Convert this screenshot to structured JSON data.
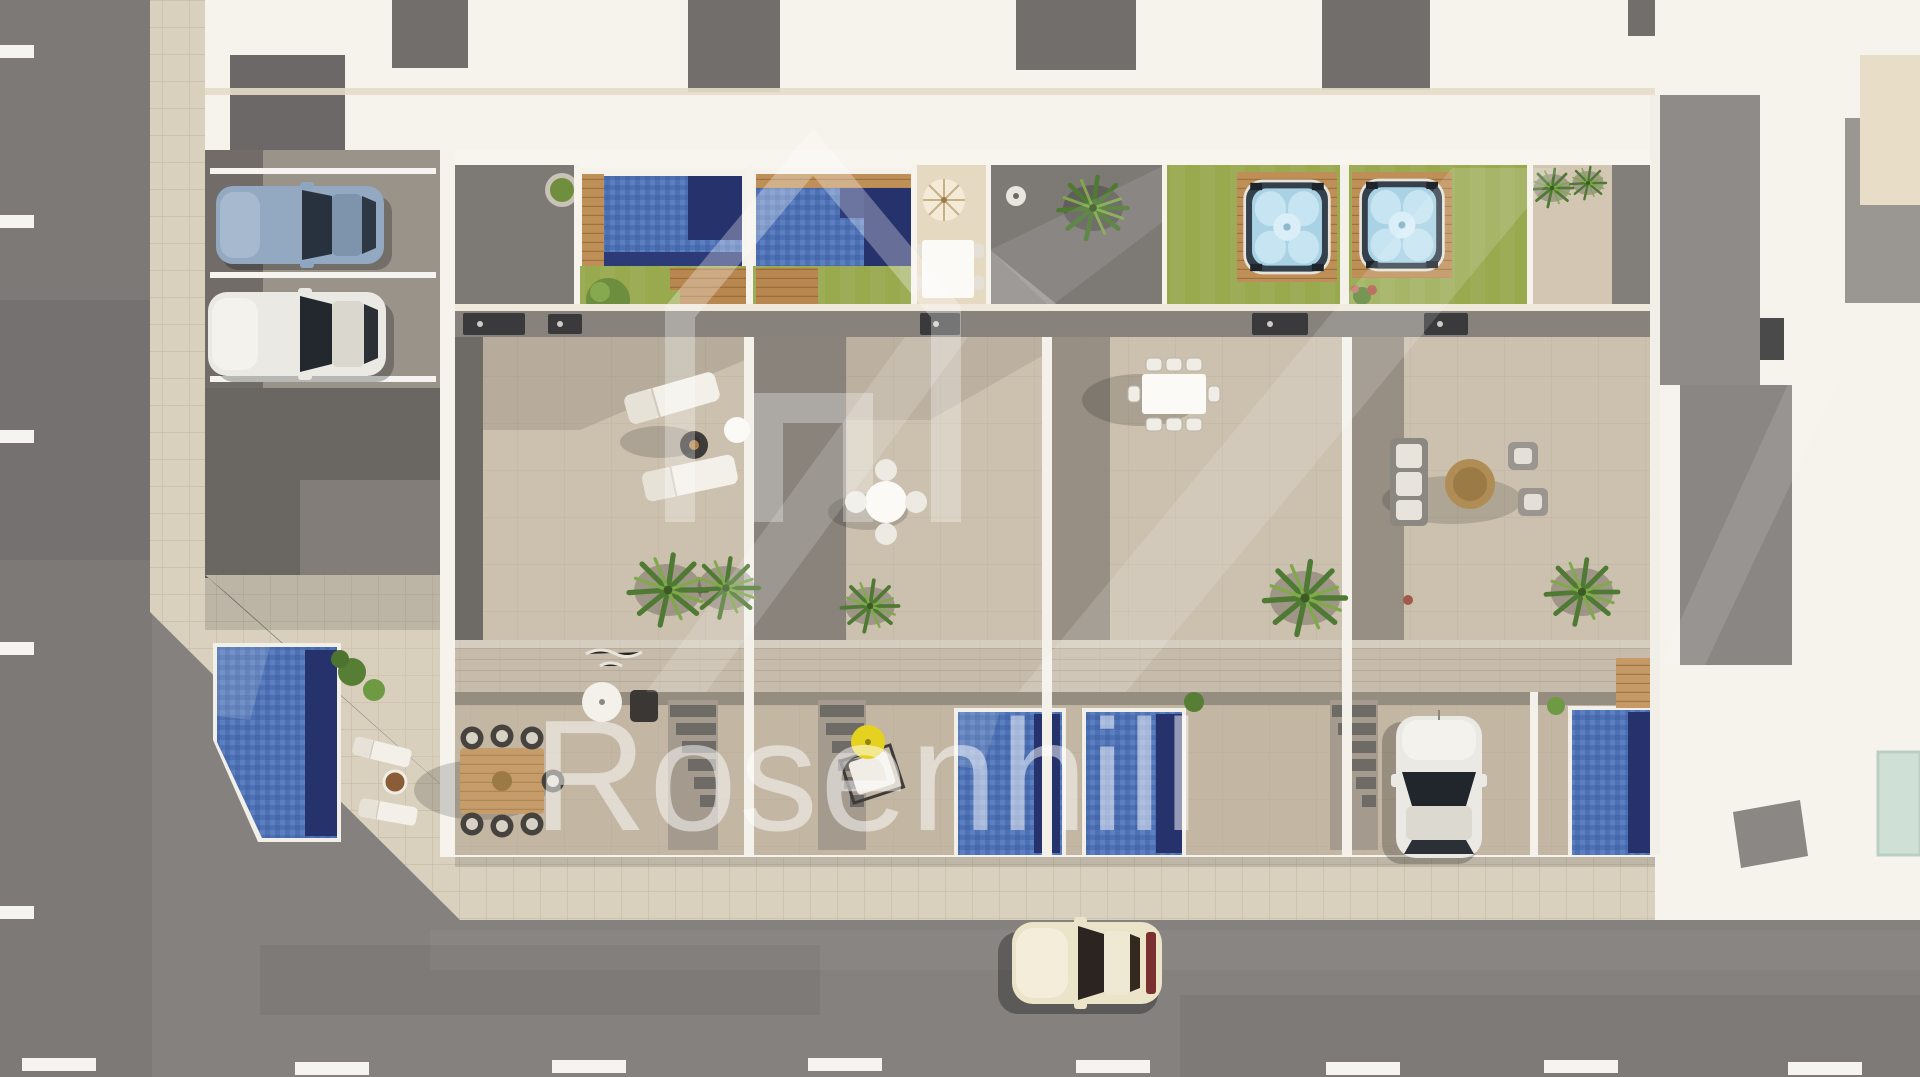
{
  "image": {
    "type": "aerial-3d-architectural-render",
    "subject": "top-down view of a row of four new-build townhouses with roof-terrace pools, hot tubs, patios, parking bays and surrounding streets",
    "units_visible": 4
  },
  "watermark": {
    "brand_text": "Rosenhill",
    "logo": "house-outline-logo",
    "text_color": "#ffffff",
    "text_opacity": 0.5,
    "logo_opacity": 0.3
  },
  "palette": {
    "asphalt_road": "#84817e",
    "asphalt_left": "#7c7977",
    "sidewalk": "#d9d0be",
    "wall_white": "#f6f3ec",
    "wall_cream": "#eadfca",
    "terrace_light": "#ccc0ae",
    "terrace_lower": "#c3b7a4",
    "patio_gray": "#7d7975",
    "roof_gray": "#6a6662",
    "neighbor_gray": "#8e8b88",
    "lawn": "#98a94e",
    "pool_water": "#4c71b6",
    "pool_deep": "#26326c",
    "wood_deck": "#bf8f58",
    "walkway_wood": "#c7bcab",
    "sand_patio": "#e6d9c2",
    "hot_tub_water": "#a9d3e4",
    "teal_glass": "#cfe0d6",
    "umbrella_yellow": "#e5d11f",
    "car_blue": "#93a8c1",
    "car_white": "#ebe9e3",
    "car_cream": "#ece4c9",
    "road_marking": "#f5f4f0",
    "plant_green": "#5c8a3c"
  },
  "scene": {
    "roads": {
      "left_road_dashes": 5,
      "bottom_road_dashes": 7
    },
    "vehicles": [
      {
        "name": "parked-car-blue",
        "color_ref": "car_blue"
      },
      {
        "name": "parked-car-white",
        "color_ref": "car_white"
      },
      {
        "name": "driveway-car-white",
        "color_ref": "car_white"
      },
      {
        "name": "street-car-cream",
        "color_ref": "car_cream"
      }
    ],
    "water_features": {
      "rooftop_pools": 2,
      "ground_pools": 4,
      "hot_tubs": 2
    },
    "furniture": [
      "sun-loungers",
      "round-dining-set",
      "rect-dining-table",
      "lounge-sofa-set",
      "wood-dining-table",
      "parasols"
    ]
  }
}
